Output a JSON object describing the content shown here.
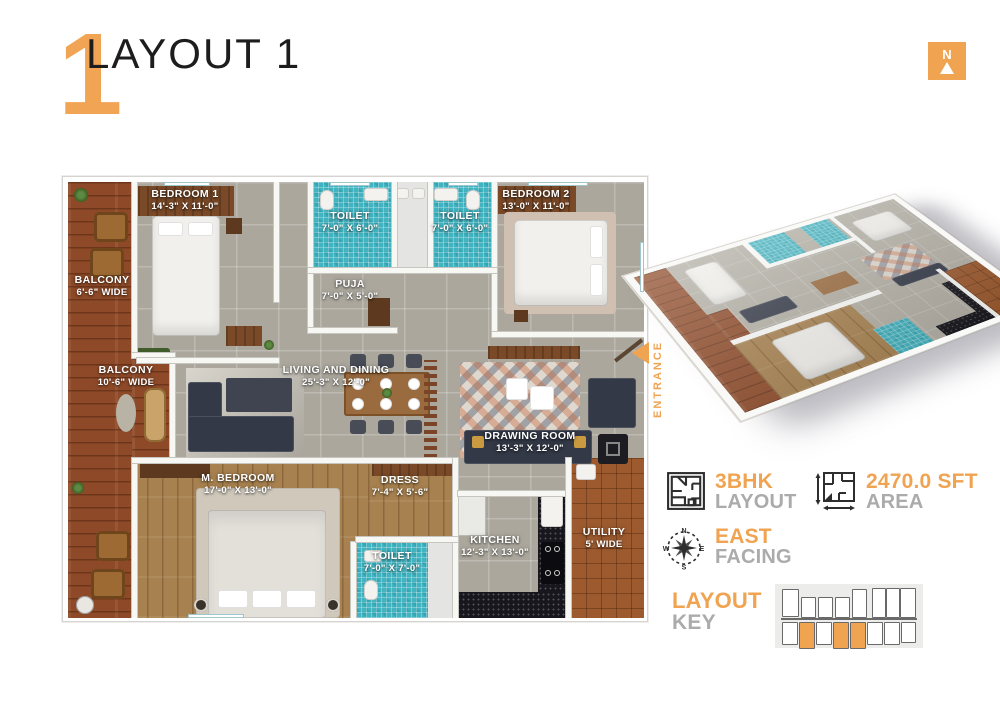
{
  "header": {
    "title": "LAYOUT 1",
    "number": "1"
  },
  "north_badge": {
    "letter": "N"
  },
  "plan": {
    "rooms": {
      "bedroom1": {
        "name": "BEDROOM 1",
        "dims": "14'-3\" X 11'-0\""
      },
      "toilet1": {
        "name": "TOILET",
        "dims": "7'-0\" X 6'-0\""
      },
      "toilet2": {
        "name": "TOILET",
        "dims": "7'-0\" X 6'-0\""
      },
      "bedroom2": {
        "name": "BEDROOM 2",
        "dims": "13'-0\" X 11'-0\""
      },
      "puja": {
        "name": "PUJA",
        "dims": "7'-0\" X 5'-0\""
      },
      "balcony_top": {
        "name": "BALCONY",
        "dims": "6'-6\" WIDE"
      },
      "balcony_bottom": {
        "name": "BALCONY",
        "dims": "10'-6\" WIDE"
      },
      "living": {
        "name": "LIVING AND DINING",
        "dims": "25'-3\" X 12'-0\""
      },
      "drawing": {
        "name": "DRAWING ROOM",
        "dims": "13'-3\" X 12'-0\""
      },
      "master_bedroom": {
        "name": "M. BEDROOM",
        "dims": "17'-0\" X 13'-0\""
      },
      "dress": {
        "name": "DRESS",
        "dims": "7'-4\" X 5'-6\""
      },
      "toilet3": {
        "name": "TOILET",
        "dims": "7'-0\" X 7'-0\""
      },
      "kitchen": {
        "name": "KITCHEN",
        "dims": "12'-3\" X 13'-0\""
      },
      "utility": {
        "name": "UTILITY",
        "dims": "5' WIDE"
      }
    },
    "entrance_label": "ENTRANCE"
  },
  "info_badges": [
    {
      "icon": "floorplan-icon",
      "value": "3BHK",
      "label": "LAYOUT"
    },
    {
      "icon": "area-icon",
      "value": "2470.0 SFT",
      "label": "AREA"
    },
    {
      "icon": "compass-icon",
      "value": "EAST",
      "label": "FACING"
    }
  ],
  "layout_key": {
    "title": "LAYOUT",
    "subtitle": "KEY",
    "units": [
      {
        "x": 7,
        "y": 5,
        "w": 15,
        "h": 26,
        "hl": 0
      },
      {
        "x": 26,
        "y": 13,
        "w": 13,
        "h": 19,
        "hl": 0
      },
      {
        "x": 43,
        "y": 13,
        "w": 13,
        "h": 19,
        "hl": 0
      },
      {
        "x": 60,
        "y": 13,
        "w": 13,
        "h": 19,
        "hl": 0
      },
      {
        "x": 77,
        "y": 5,
        "w": 13,
        "h": 27,
        "hl": 0
      },
      {
        "x": 97,
        "y": 4,
        "w": 12,
        "h": 28,
        "hl": 0
      },
      {
        "x": 111,
        "y": 4,
        "w": 12,
        "h": 28,
        "hl": 0
      },
      {
        "x": 125,
        "y": 4,
        "w": 14,
        "h": 28,
        "hl": 0
      },
      {
        "x": 7,
        "y": 38,
        "w": 14,
        "h": 21,
        "hl": 0
      },
      {
        "x": 24,
        "y": 38,
        "w": 14,
        "h": 25,
        "hl": 1
      },
      {
        "x": 41,
        "y": 38,
        "w": 14,
        "h": 21,
        "hl": 0
      },
      {
        "x": 58,
        "y": 38,
        "w": 14,
        "h": 25,
        "hl": 1
      },
      {
        "x": 75,
        "y": 38,
        "w": 14,
        "h": 25,
        "hl": 1
      },
      {
        "x": 92,
        "y": 38,
        "w": 14,
        "h": 21,
        "hl": 0
      },
      {
        "x": 109,
        "y": 38,
        "w": 14,
        "h": 21,
        "hl": 0
      },
      {
        "x": 126,
        "y": 38,
        "w": 13,
        "h": 19,
        "hl": 0
      }
    ]
  },
  "colors": {
    "accent": "#F0A351",
    "muted_text": "#ABABAB",
    "teal_floor": "#41B4C1",
    "deck_wood": "#8E4A28",
    "bedroom_wood": "#A7814F",
    "utility_wood": "#9C5A2E",
    "kitchen_counter": "#17171D"
  }
}
